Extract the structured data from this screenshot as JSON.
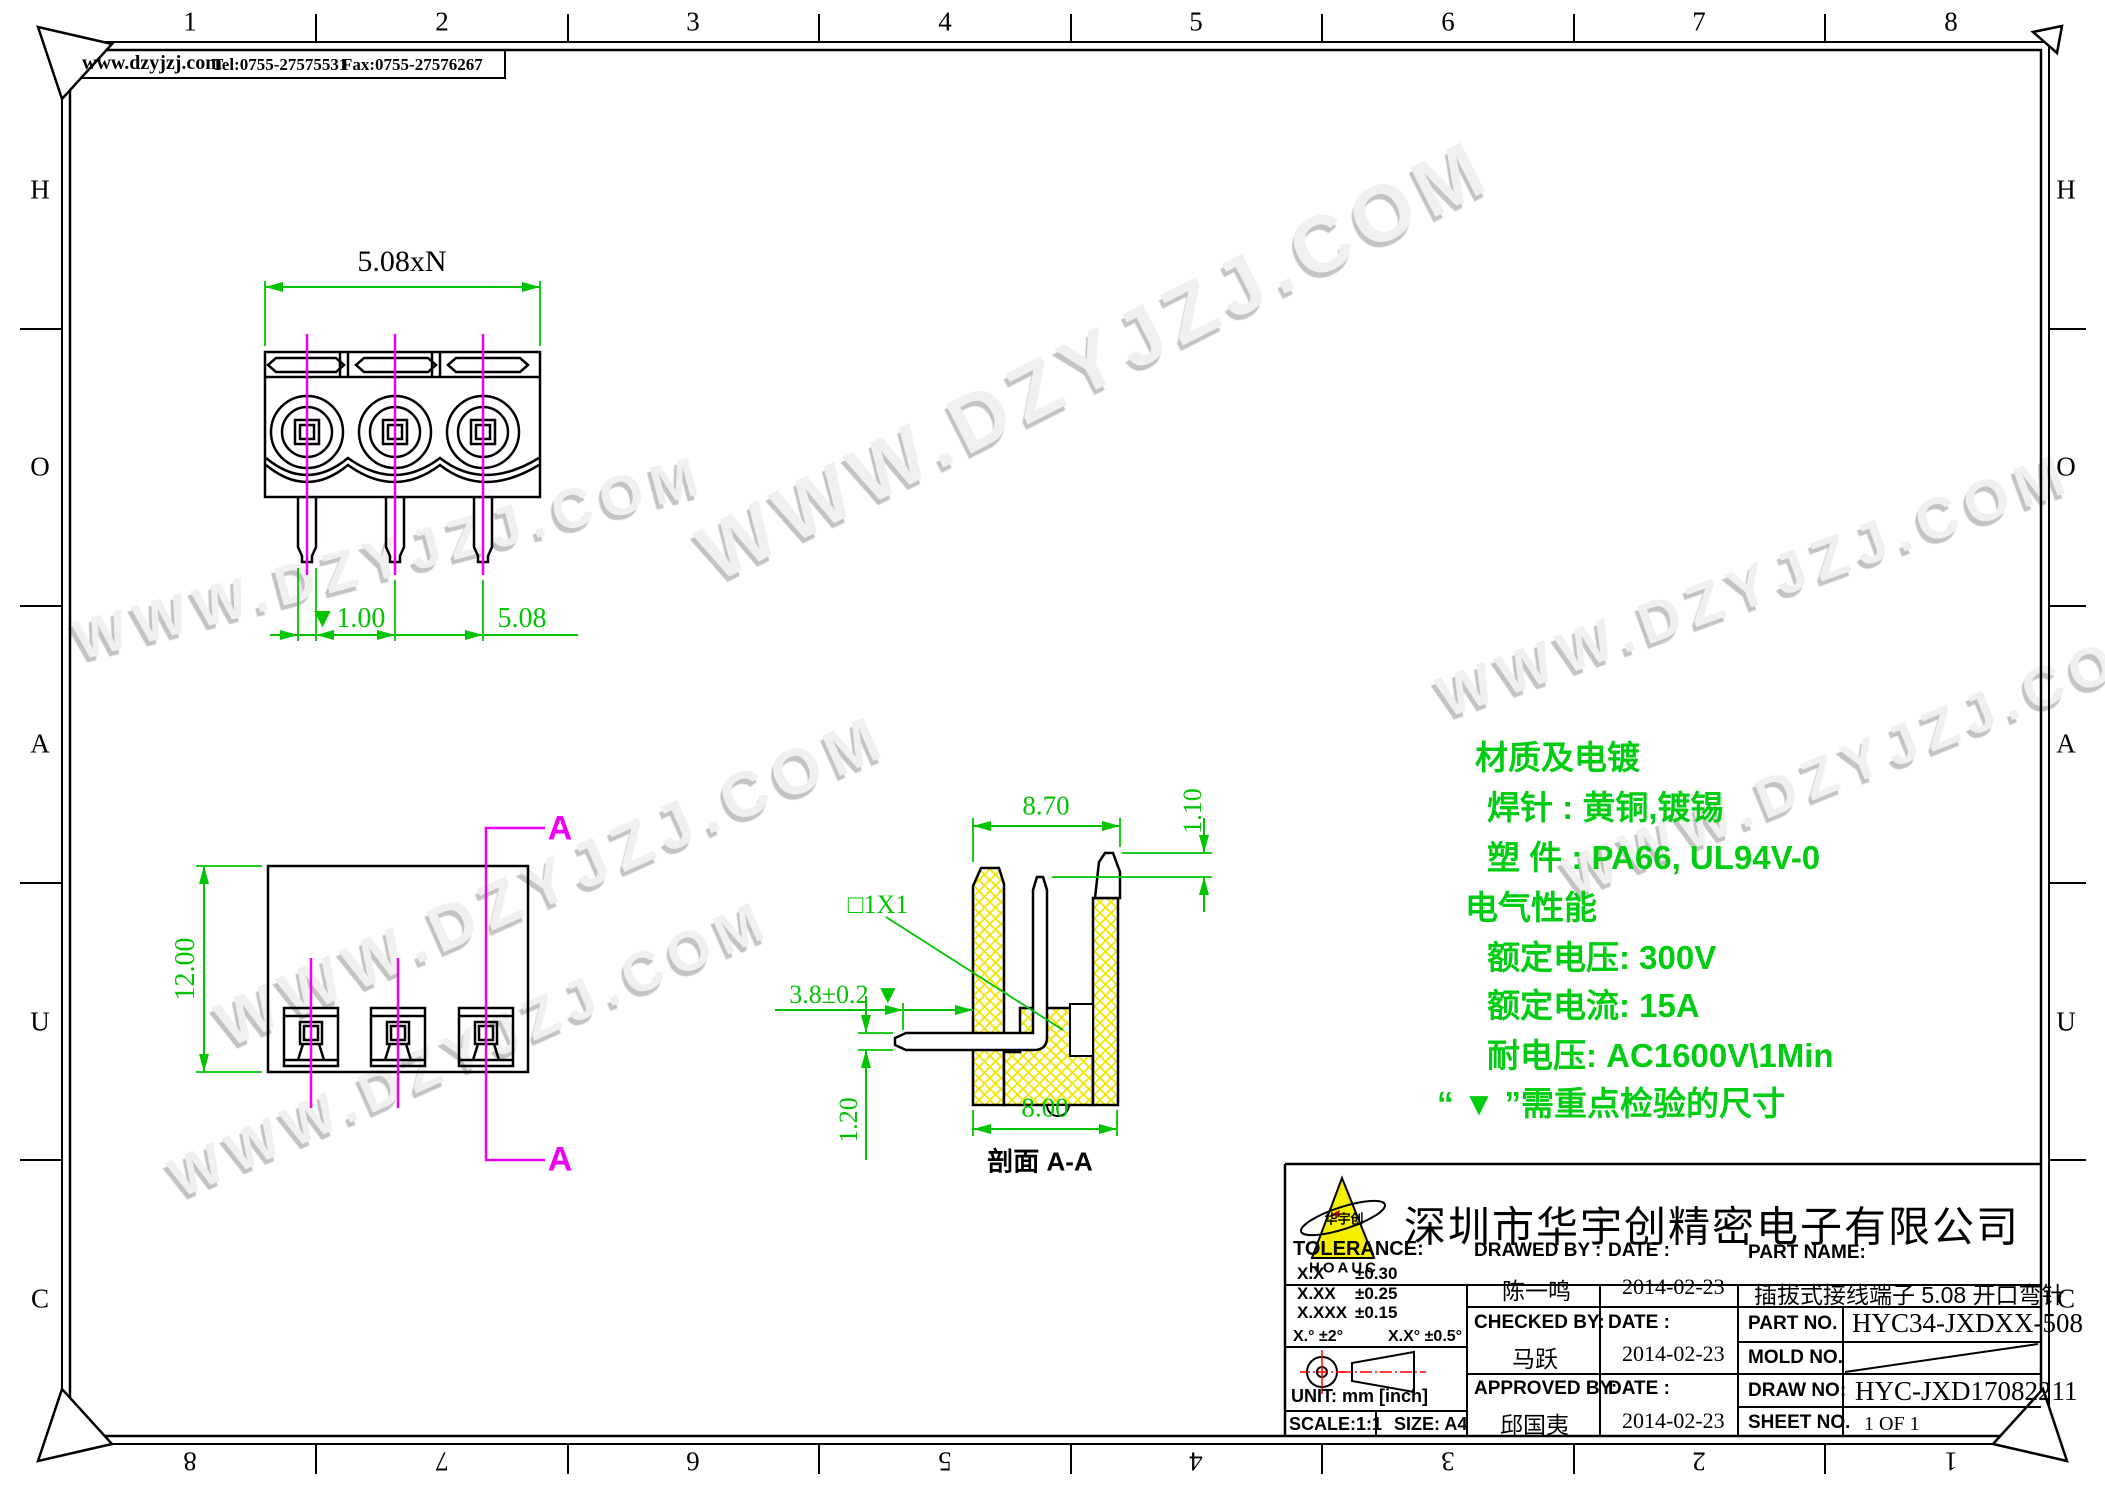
{
  "page": {
    "watermark": "WWW.DZYJZJ.COM"
  },
  "contact": {
    "website": "www.dzyjzj.com",
    "tel": "Tel:0755-27575531",
    "fax": "Fax:0755-27576267"
  },
  "border": {
    "top": [
      "1",
      "2",
      "3",
      "4",
      "5",
      "6",
      "7",
      "8"
    ],
    "bottom": [
      "8",
      "7",
      "6",
      "5",
      "4",
      "3",
      "2",
      "1"
    ],
    "left": [
      "H",
      "O",
      "A",
      "U",
      "C"
    ],
    "right": [
      "H",
      "O",
      "A",
      "U",
      "C"
    ]
  },
  "front_view": {
    "dim_total": "5.08xN",
    "dim_pin_width": "▼1.00",
    "dim_pitch": "5.08"
  },
  "side_view": {
    "dim_height": "12.00",
    "section_label_top": "A",
    "section_label_bottom": "A"
  },
  "section_view": {
    "dim_top": "8.70",
    "dim_tooth": "1.10",
    "pin_note": "□1X1",
    "pin_protrusion": "3.8±0.2 ▼",
    "pin_thickness": "1.20",
    "dim_bottom": "8.00",
    "caption": "剖面 A-A"
  },
  "specs": {
    "line1": "材质及电镀",
    "line2": "焊针 : 黄铜,镀锡",
    "line3": "塑 件 : PA66, UL94V-0",
    "line4": "电气性能",
    "line5": "额定电压: 300V",
    "line6": "额定电流: 15A",
    "line7": "耐电压: AC1600V\\1Min",
    "line8": "“ ▼ ”需重点检验的尺寸"
  },
  "title_block": {
    "company": "深圳市华宇创精密电子有限公司",
    "logo_text": "HOAUC",
    "logo_cn": "华宇创",
    "tolerance_label": "TOLERANCE:",
    "tol_rows": [
      {
        "k": "X.X",
        "v": "±0.30"
      },
      {
        "k": "X.XX",
        "v": "±0.25"
      },
      {
        "k": "X.XXX",
        "v": "±0.15"
      }
    ],
    "tol_angle1": "X.°  ±2°",
    "tol_angle2": "X.X°  ±0.5°",
    "unit": "UNIT:  mm  [inch]",
    "scale": "SCALE:1:1",
    "size": "SIZE:  A4",
    "drawed_by_label": "DRAWED  BY :",
    "drawed_by": "陈一鸣",
    "checked_by_label": "CHECKED  BY:",
    "checked_by": "马跃",
    "approved_by_label": "APPROVED  BY:",
    "approved_by": "邱国夷",
    "date_label": "DATE :",
    "date_drawed": "2014-02-23",
    "date_checked": "2014-02-23",
    "date_approved": "2014-02-23",
    "part_name_label": "PART  NAME:",
    "part_name": "插拔式接线端子 5.08 开口弯针",
    "part_no_label": "PART  NO.",
    "part_no": "HYC34-JXDXX-508",
    "mold_no_label": "MOLD  NO.",
    "draw_no_label": "DRAW  NO:",
    "draw_no": "HYC-JXD17082211",
    "sheet_no_label": "SHEET  NO.",
    "sheet_no": "1 OF 1"
  }
}
